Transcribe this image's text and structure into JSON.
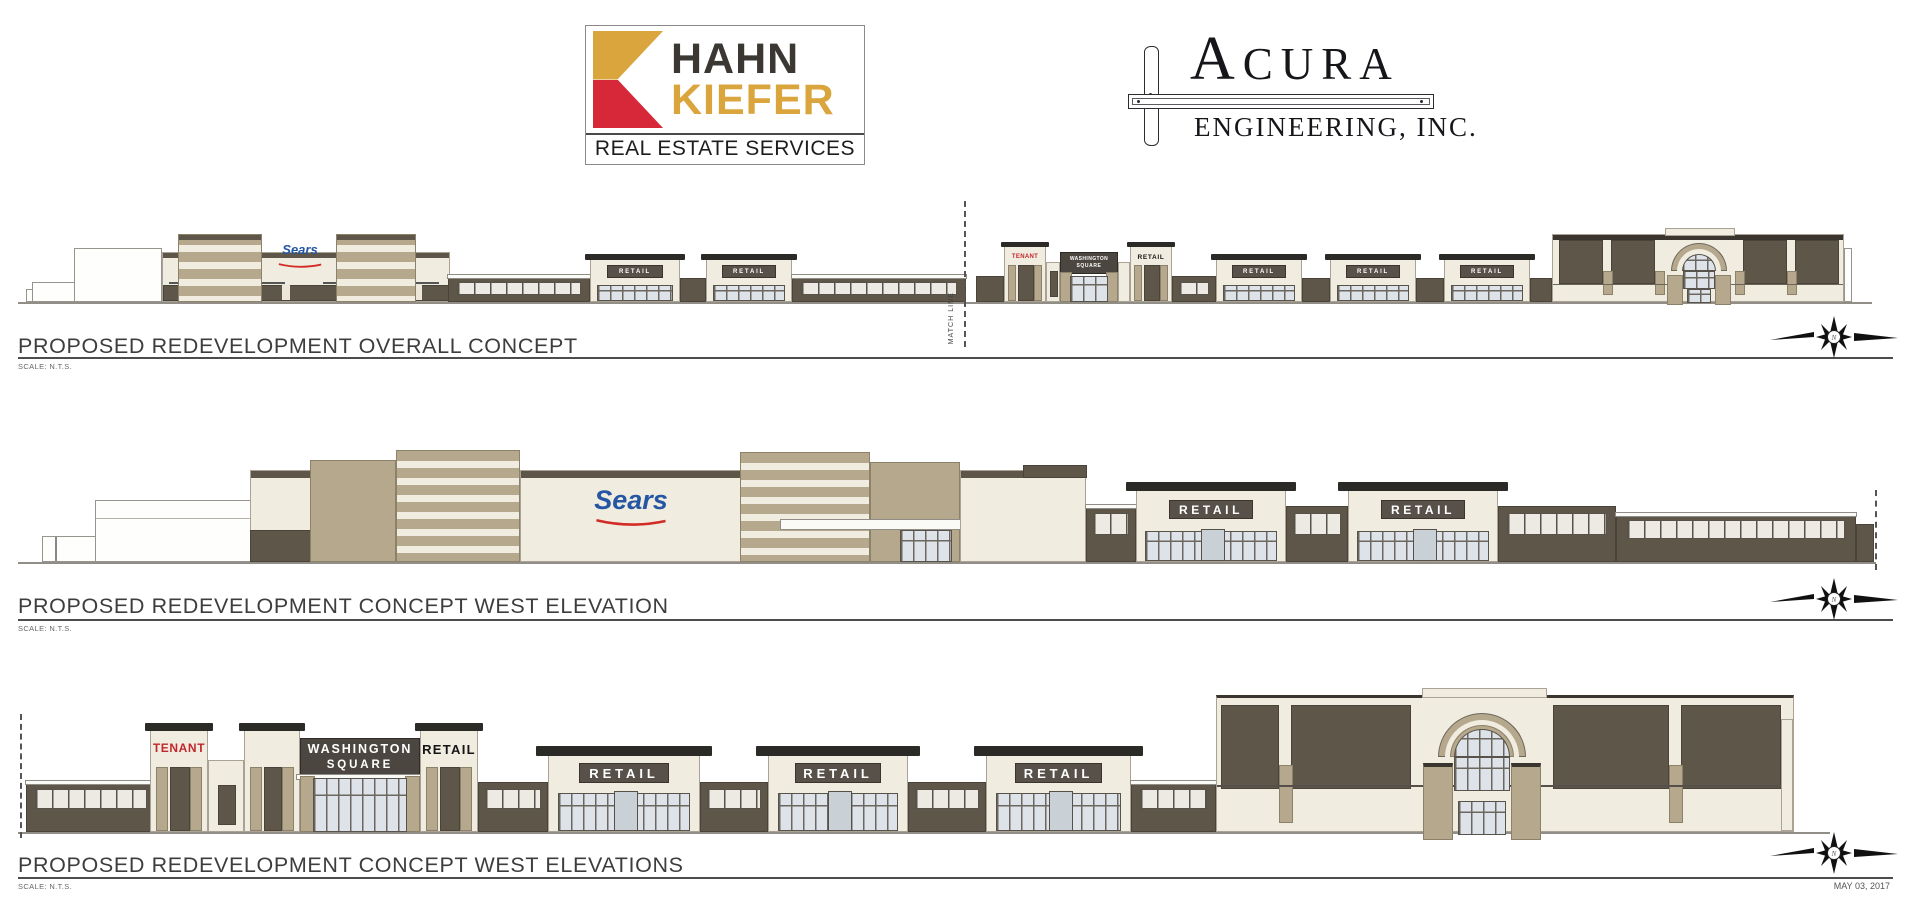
{
  "header": {
    "hahn_kiefer": {
      "line1": "HAHN",
      "line2": "KIEFER",
      "tagline": "REAL ESTATE SERVICES"
    },
    "acura": {
      "initial": "A",
      "rest": "CURA",
      "line2": "ENGINEERING, INC."
    }
  },
  "labels": {
    "sears": "Sears",
    "retail": "RETAIL",
    "washington_square_line1": "WASHINGTON",
    "washington_square_line2": "SQUARE",
    "tenant": "TENANT",
    "match_line": "MATCH LINE",
    "north": "N"
  },
  "sections": [
    {
      "title": "PROPOSED REDEVELOPMENT OVERALL CONCEPT",
      "scale": "SCALE: N.T.S."
    },
    {
      "title": "PROPOSED REDEVELOPMENT CONCEPT WEST ELEVATION",
      "scale": "SCALE: N.T.S."
    },
    {
      "title": "PROPOSED REDEVELOPMENT CONCEPT WEST ELEVATIONS",
      "scale": "SCALE: N.T.S."
    }
  ],
  "footer": {
    "date": "MAY 03, 2017"
  },
  "palette": {
    "wall_dark": "#5d5649",
    "wall_tan": "#b6a88c",
    "wall_cream": "#f1ece0",
    "roof_dark": "#2b2a26",
    "sears_blue": "#2456a4",
    "sears_red": "#d22c26",
    "tenant_red": "#c1272d",
    "hk_gold": "#d9a53c",
    "hk_red": "#d62839",
    "hk_dark": "#3b3733"
  }
}
